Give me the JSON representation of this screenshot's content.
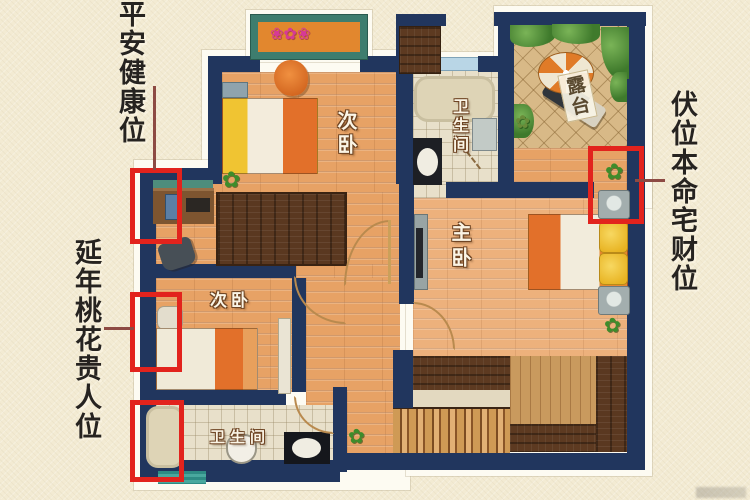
{
  "annotations": {
    "top_left": "平安健康位",
    "bottom_left": "延年桃花贵人位",
    "right": "伏位本命宅财位"
  },
  "rooms": {
    "bedroom_top": "次卧",
    "bedroom_left": "次卧",
    "master": "主卧",
    "bathroom_top": "卫生间",
    "bathroom_bottom": "卫生间",
    "terrace": "露台"
  },
  "icons": {
    "plant": "✿",
    "flowers": "❀✿❀"
  },
  "colors": {
    "background": "#f3ebd3",
    "wall_navy": "#21365e",
    "highlight_red": "#e2231d",
    "leader_line": "#8d4a43",
    "wood_floor": "#e7a265",
    "master_floor": "#edb17c",
    "dark_wood": "#5a3820",
    "bathroom_tile": "#e8e0ca",
    "terrace_tile": "#d8b987",
    "window_teal": "#3e7d6e",
    "bed_orange": "#e2702a",
    "pillow_yellow": "#f0c432",
    "annotation_text": "#262320"
  }
}
